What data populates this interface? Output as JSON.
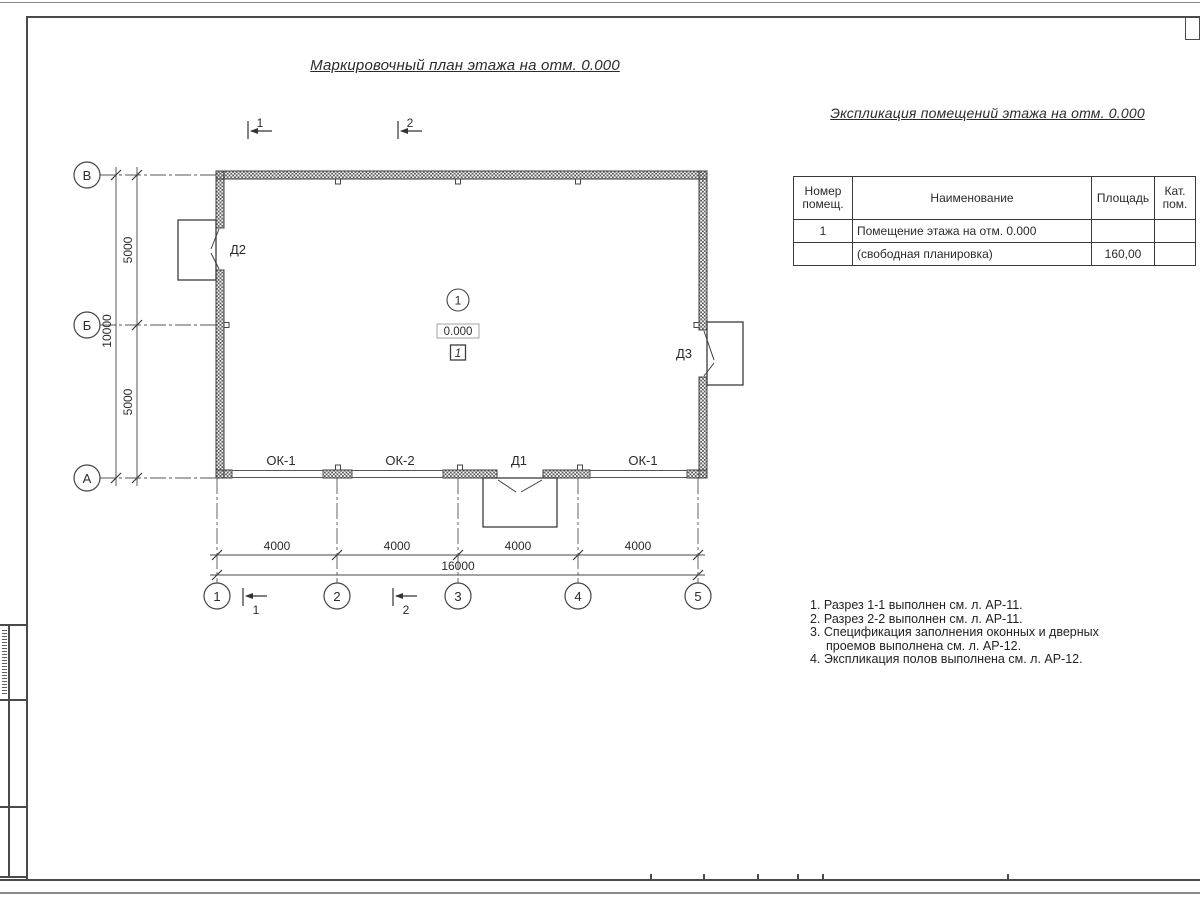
{
  "colors": {
    "line": "#3c3c3c",
    "frame": "#4a4a4a",
    "text": "#2b2b2b"
  },
  "plan": {
    "title": "Маркировочный план этажа на отм. 0.000",
    "axes_left": [
      "В",
      "Б",
      "А"
    ],
    "axes_bottom": [
      "1",
      "2",
      "3",
      "4",
      "5"
    ],
    "dims_left": [
      "5000",
      "5000"
    ],
    "dim_left_total": "10000",
    "dims_bottom": [
      "4000",
      "4000",
      "4000",
      "4000"
    ],
    "dim_bottom_total": "16000",
    "section_marks": [
      "1",
      "2"
    ],
    "room": {
      "number": "1",
      "elevation": "0.000",
      "floor_mark": "1"
    },
    "door_labels": {
      "left": "Д2",
      "right": "Д3"
    },
    "opening_labels": [
      "ОК-1",
      "ОК-2",
      "Д1",
      "ОК-1"
    ]
  },
  "explication": {
    "title": "Экспликация помещений этажа на отм. 0.000",
    "headers": [
      "Номер помещ.",
      "Наименование",
      "Площадь",
      "Кат. пом."
    ],
    "rows": [
      {
        "num": "1",
        "name": "Помещение этажа на отм. 0.000",
        "area": "",
        "cat": ""
      },
      {
        "num": "",
        "name": "(свободная планировка)",
        "area": "160,00",
        "cat": ""
      }
    ]
  },
  "notes": [
    "1. Разрез 1-1 выполнен см. л. АР-11.",
    "2. Разрез 2-2 выполнен см. л. АР-11.",
    "3. Спецификация заполнения оконных и дверных",
    "проемов выполнена см. л. АР-12.",
    "4. Экспликация полов выполнена см. л. АР-12."
  ]
}
